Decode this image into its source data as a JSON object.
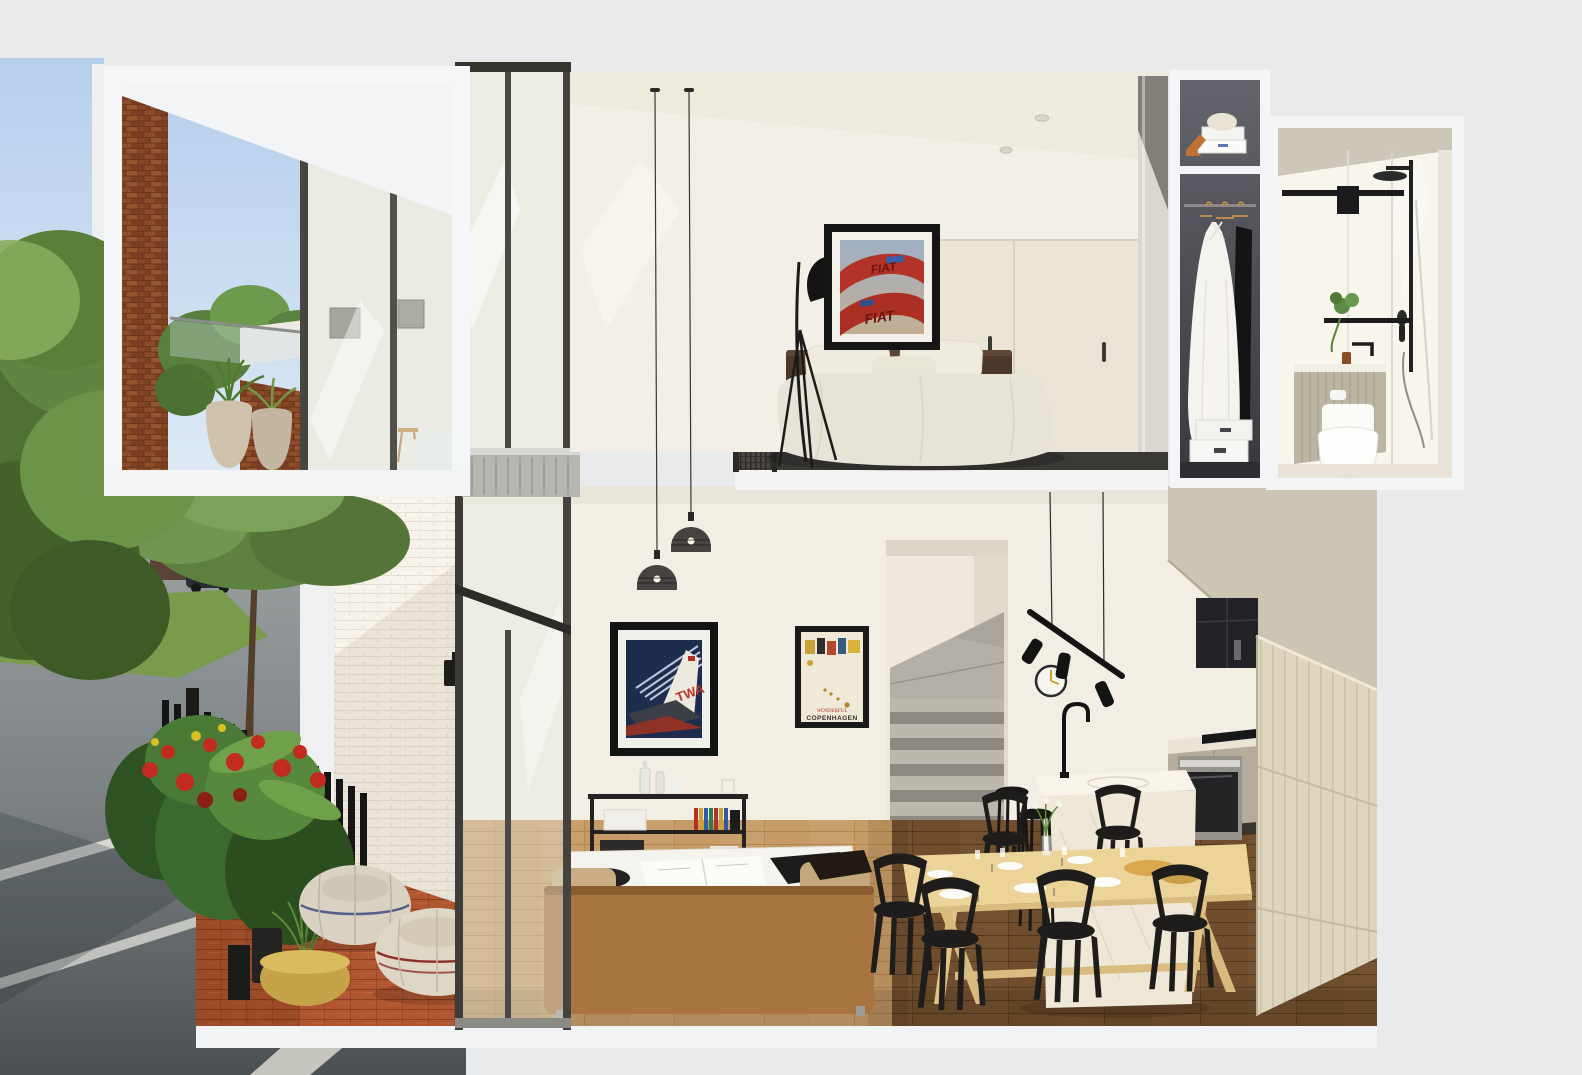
{
  "scene": {
    "type": "architectural-cutaway-render",
    "posters": {
      "fiat": {
        "text_top": "FIAT",
        "text_bottom": "FIAT"
      },
      "twa": {
        "text": "TWA"
      },
      "copenhagen": {
        "text_script": "WONDERFUL",
        "text_main": "COPENHAGEN"
      }
    },
    "floors": [
      {
        "name": "upper",
        "rooms": [
          "balcony-terrace",
          "bedroom-loft",
          "wardrobe",
          "bathroom"
        ]
      },
      {
        "name": "lower",
        "rooms": [
          "living-room",
          "dining-area",
          "kitchen",
          "stairs",
          "courtyard",
          "street"
        ]
      }
    ],
    "palette": {
      "background_grey": "#e8eaec",
      "sky_blue": "#bdd3ec",
      "brick_red": "#7b3f22",
      "brick_white": "#f7f3ea",
      "wall_cream": "#f2eee4",
      "wood_light": "#c69b67",
      "wood_dark": "#6f4d2d",
      "terracotta": "#b05630",
      "sofa_tan": "#a8743f",
      "table_birch": "#ecd498",
      "fixture_black": "#1b1b1b",
      "greige_cabinet": "#b5ac9b",
      "concrete_stair": "#bdb8ae",
      "foliage_green": "#5f8140",
      "flower_red": "#c22b20",
      "pouf_linen": "#d9d2c2",
      "gold_planter": "#c5a348"
    }
  }
}
